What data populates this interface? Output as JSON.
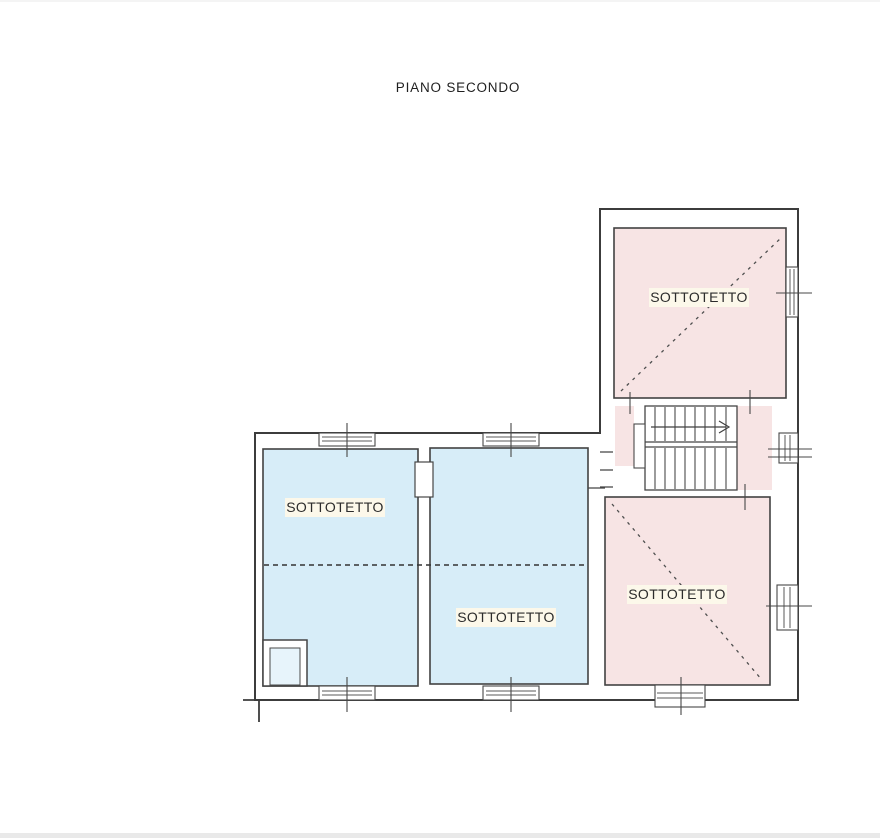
{
  "title": "PIANO SECONDO",
  "colors": {
    "attic_pink": "#f7e4e4",
    "attic_blue": "#d7edf8",
    "label_bg": "#fcf8ea",
    "duct_blue": "#e7f4fb"
  },
  "rooms": [
    {
      "id": "attic-north-east",
      "label": "SOTTOTETTO"
    },
    {
      "id": "attic-south-east",
      "label": "SOTTOTETTO"
    },
    {
      "id": "attic-west",
      "label": "SOTTOTETTO"
    },
    {
      "id": "attic-center",
      "label": "SOTTOTETTO"
    }
  ],
  "stairs": {
    "direction": "right"
  }
}
